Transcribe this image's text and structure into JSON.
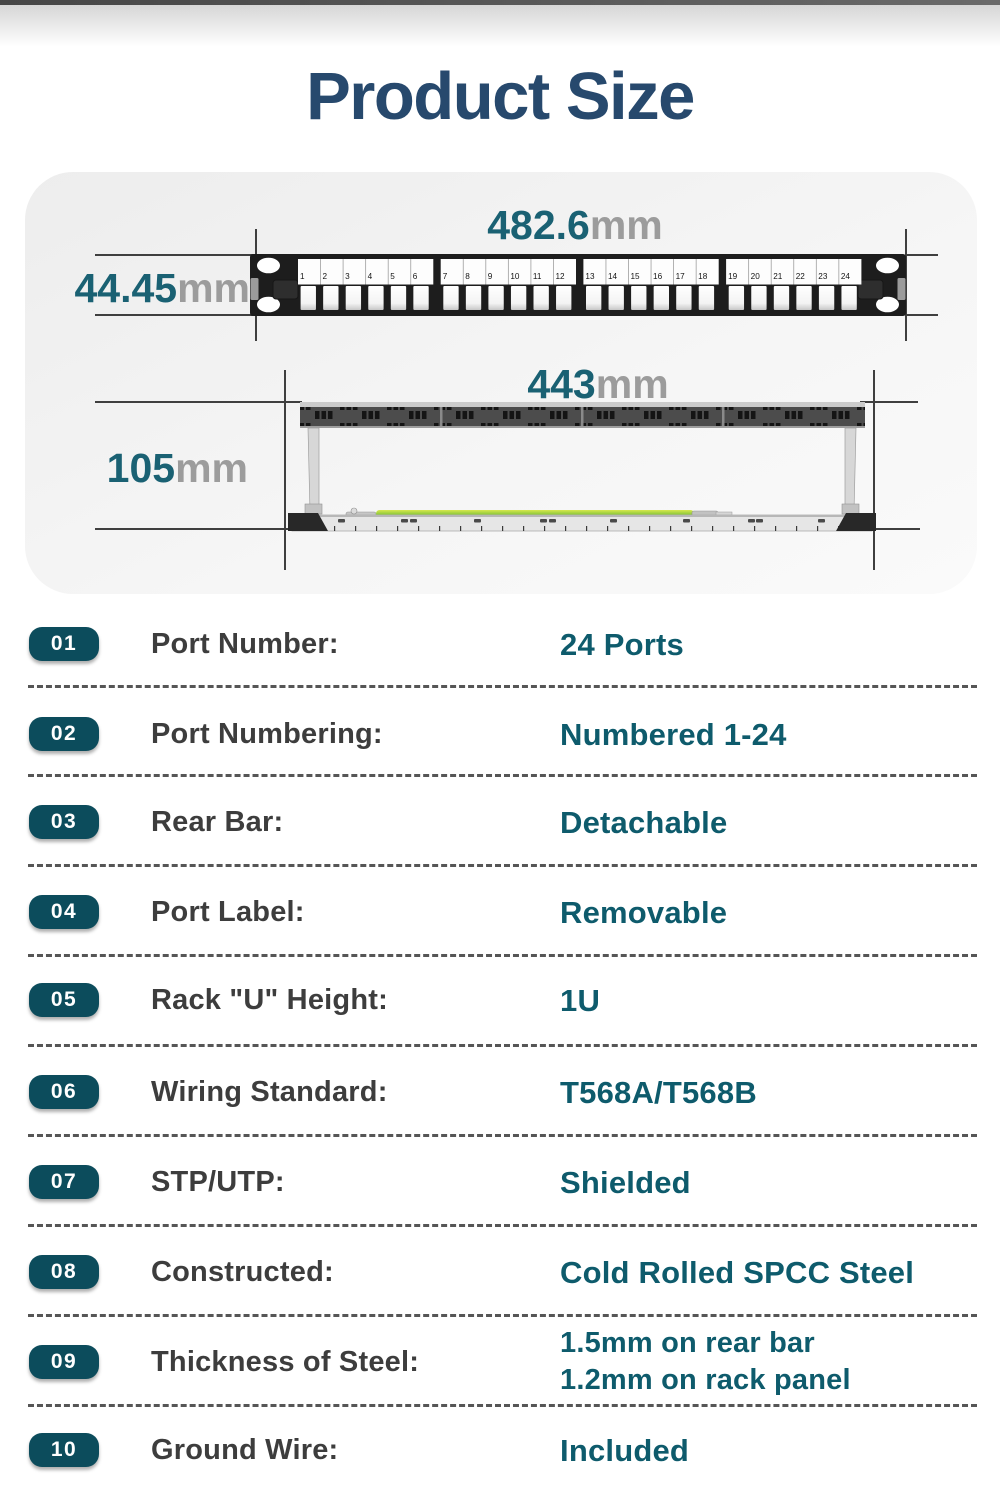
{
  "page": {
    "title": "Product Size"
  },
  "diagram": {
    "front_view": {
      "width": {
        "value": "482.6",
        "unit": "mm"
      },
      "height": {
        "value": "44.45",
        "unit": "mm"
      },
      "port_numbers": [
        "1",
        "2",
        "3",
        "4",
        "5",
        "6",
        "7",
        "8",
        "9",
        "10",
        "11",
        "12",
        "13",
        "14",
        "15",
        "16",
        "17",
        "18",
        "19",
        "20",
        "21",
        "22",
        "23",
        "24"
      ]
    },
    "rear_view": {
      "width": {
        "value": "443",
        "unit": "mm"
      },
      "height": {
        "value": "105",
        "unit": "mm"
      }
    }
  },
  "specs": {
    "rows": [
      {
        "num": "01",
        "label": "Port Number:",
        "values": [
          "24 Ports"
        ]
      },
      {
        "num": "02",
        "label": "Port Numbering:",
        "values": [
          "Numbered 1-24"
        ]
      },
      {
        "num": "03",
        "label": "Rear Bar:",
        "values": [
          "Detachable"
        ]
      },
      {
        "num": "04",
        "label": "Port Label:",
        "values": [
          "Removable"
        ]
      },
      {
        "num": "05",
        "label": "Rack \"U\" Height:",
        "values": [
          "1U"
        ]
      },
      {
        "num": "06",
        "label": "Wiring Standard:",
        "values": [
          "T568A/T568B"
        ]
      },
      {
        "num": "07",
        "label": "STP/UTP:",
        "values": [
          "Shielded"
        ]
      },
      {
        "num": "08",
        "label": "Constructed:",
        "values": [
          "Cold Rolled SPCC Steel"
        ]
      },
      {
        "num": "09",
        "label": "Thickness of Steel:",
        "values": [
          "1.5mm on rear bar",
          "1.2mm on rack panel"
        ]
      },
      {
        "num": "10",
        "label": "Ground Wire:",
        "values": [
          "Included"
        ]
      }
    ]
  },
  "colors": {
    "title_navy": "#27496d",
    "value_teal": "#0e5b6c",
    "badge_teal": "#0c4c5c",
    "dimension_teal": "#1a6173",
    "unit_gray": "#9c9c9c",
    "ground_wire_green": "#8dc63f"
  }
}
